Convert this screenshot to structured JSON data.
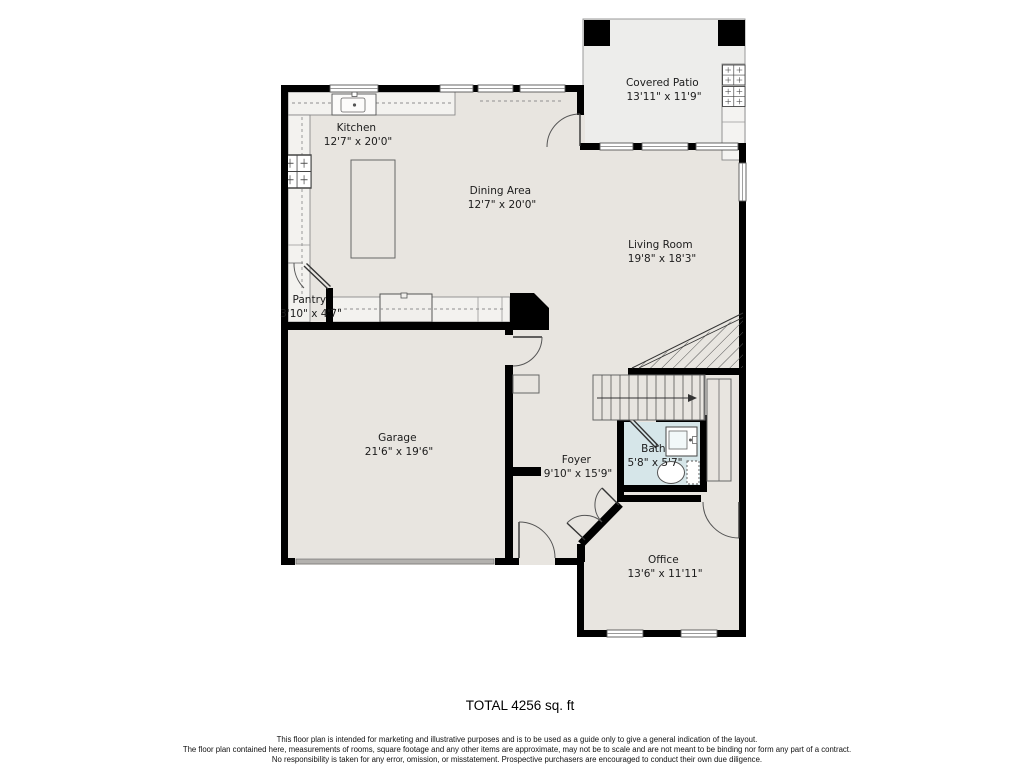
{
  "plan": {
    "total_label": "TOTAL 4256 sq. ft",
    "disclaimer": [
      "This floor plan is intended for marketing and illustrative purposes and is to be used as a guide only to give a general indication of the layout.",
      "The floor plan contained here, measurements of rooms, square footage and any other items are approximate, may not be to scale and are not meant to be binding nor form any part of a contract.",
      "No responsibility is taken for any error, omission, or misstatement. Prospective purchasers are encouraged to conduct their own due diligence."
    ]
  },
  "rooms": {
    "covered_patio": {
      "name": "Covered Patio",
      "dims": "13'11\" x 11'9\""
    },
    "kitchen": {
      "name": "Kitchen",
      "dims": "12'7\" x 20'0\""
    },
    "dining_area": {
      "name": "Dining Area",
      "dims": "12'7\" x 20'0\""
    },
    "living_room": {
      "name": "Living Room",
      "dims": "19'8\" x 18'3\""
    },
    "pantry": {
      "name": "Pantry",
      "dims": "3'10\" x 4'7\""
    },
    "garage": {
      "name": "Garage",
      "dims": "21'6\" x 19'6\""
    },
    "foyer": {
      "name": "Foyer",
      "dims": "9'10\" x 15'9\""
    },
    "bath": {
      "name": "Bath",
      "dims": "5'8\" x 5'7\""
    },
    "office": {
      "name": "Office",
      "dims": "13'6\" x 11'11\""
    }
  },
  "colors": {
    "wall": "#000000",
    "floor": "#e8e5e0",
    "patio_floor": "#ededeb",
    "bath_floor": "#d6e6e9",
    "counter": "#f3f2ef",
    "garage_door": "#b3b1ae",
    "label": "#1c1c1c"
  }
}
